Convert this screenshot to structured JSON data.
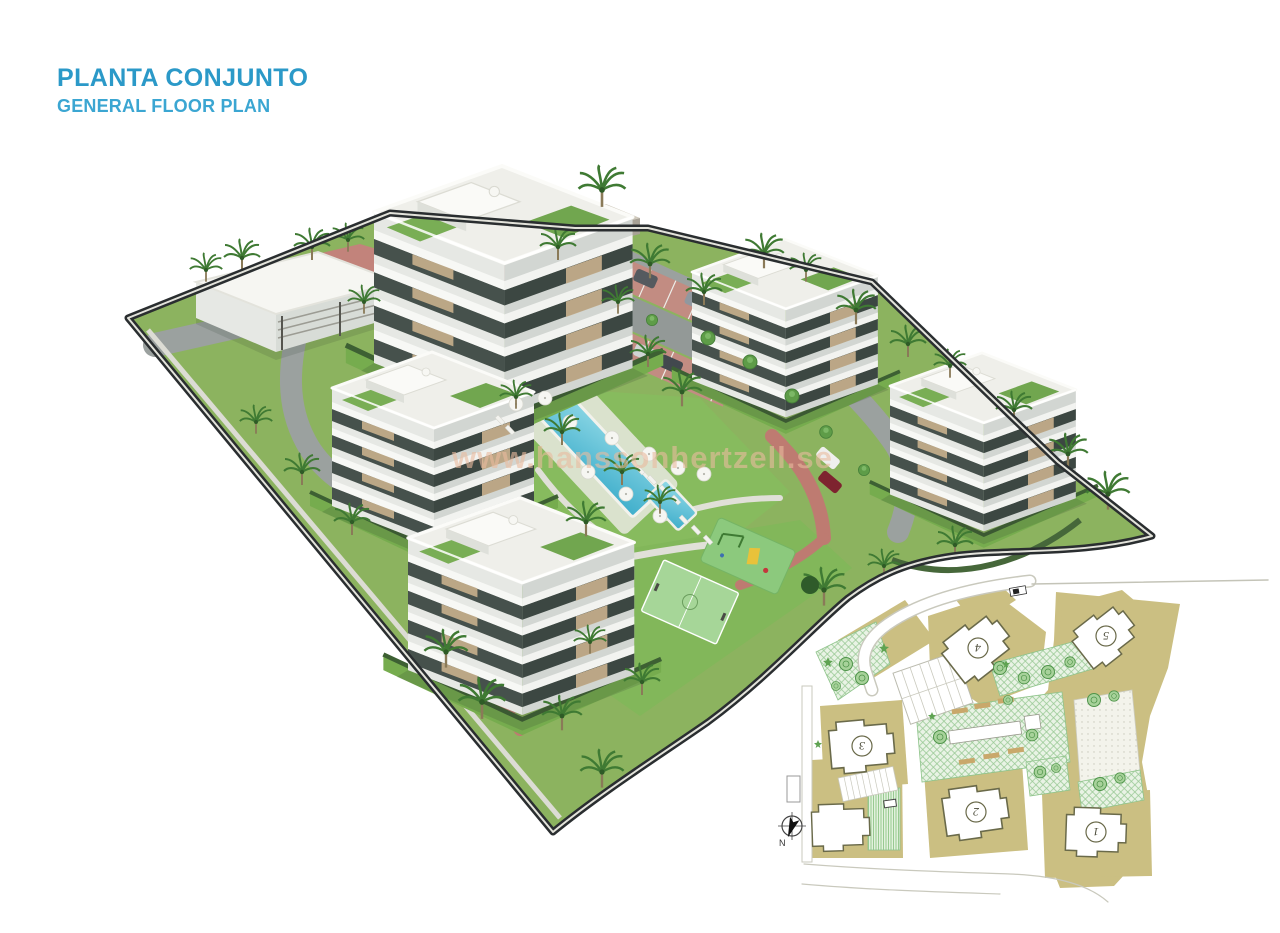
{
  "header": {
    "title": "PLANTA CONJUNTO",
    "subtitle": "GENERAL FLOOR PLAN"
  },
  "watermark": {
    "text": "www.hanssonhertzell.se"
  },
  "colors": {
    "title": "#2B99C8",
    "subtitle": "#3BA6D2",
    "watermark": "#EABA9E",
    "grass": "#8CB35F",
    "road": "#9BA19F",
    "paving_red": "#BE7B71",
    "pool_water": "#4FB8D2",
    "perimeter_wall": "#2A2E30",
    "plan_ground": "#CBBF82",
    "plan_green": "#E9F3E5",
    "plan_building_outline": "#6A6A4A"
  },
  "site_plan": {
    "north_label": "N",
    "buildings": [
      {
        "label": "1"
      },
      {
        "label": "2"
      },
      {
        "label": "3"
      },
      {
        "label": "4"
      },
      {
        "label": "5"
      }
    ]
  }
}
